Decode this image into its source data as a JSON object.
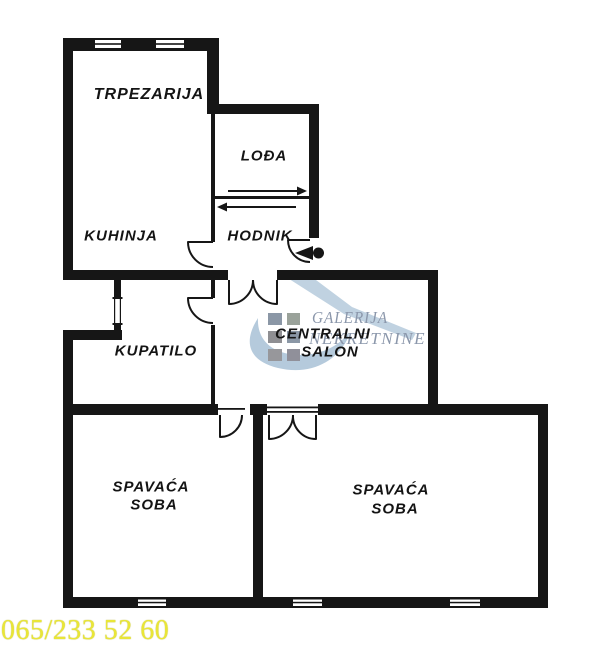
{
  "floorplan": {
    "wall_color": "#161616",
    "rooms": {
      "trpezarija": "TRPEZARIJA",
      "lodja": "LOĐA",
      "kuhinja": "KUHINJA",
      "hodnik": "HODNIK",
      "kupatilo": "KUPATILO",
      "salon_line1": "CENTRALNI",
      "salon_line2": "SALON",
      "bedroom_left_line1": "SPAVAĆA",
      "bedroom_left_line2": "SOBA",
      "bedroom_right_line1": "SPAVAĆA",
      "bedroom_right_line2": "SOBA"
    },
    "symbols": {
      "door": "quarter-arc-swing",
      "double_door": "two-quarter-arcs",
      "entrance_marker": "filled-triangle-with-dot",
      "window": "striped-wall-segment",
      "loggia_arrow": "arrow-right",
      "hallway_arrow": "arrow-left"
    }
  },
  "watermark": {
    "line1": "GALERIJA",
    "line2": "NEKRETNINE",
    "text_color": "#8b97ab",
    "swoosh_color": "#b5cadc",
    "square_colors": [
      "#8b97a6",
      "#9aa29a",
      "#8f8f93",
      "#8b97a6",
      "#97979b",
      "#90909a"
    ]
  },
  "footer": {
    "phone": "065/233 52 60",
    "color": "#e9e637"
  }
}
